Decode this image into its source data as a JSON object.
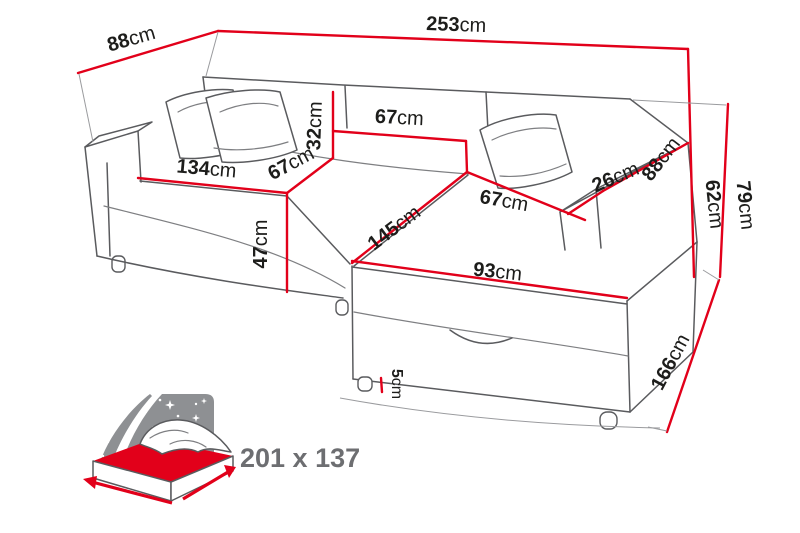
{
  "diagram_type": "corner-sofa-bed-dimension-diagram",
  "unit": "cm",
  "labels": {
    "back_depth": {
      "num": "88",
      "unit": "cm"
    },
    "total_width": {
      "num": "253",
      "unit": "cm"
    },
    "total_height": {
      "num": "79",
      "unit": "cm"
    },
    "armrest_height": {
      "num": "62",
      "unit": "cm"
    },
    "right_armrest_depth": {
      "num": "88",
      "unit": "cm"
    },
    "right_armrest_width": {
      "num": "26",
      "unit": "cm"
    },
    "chaise_length": {
      "num": "166",
      "unit": "cm"
    },
    "backrest_cushion_height": {
      "num": "32",
      "unit": "cm"
    },
    "backrest_cushion_width": {
      "num": "67",
      "unit": "cm"
    },
    "seat_depth": {
      "num": "67",
      "unit": "cm"
    },
    "right_seat_width": {
      "num": "67",
      "unit": "cm"
    },
    "left_seat_width": {
      "num": "134",
      "unit": "cm"
    },
    "chaise_depth": {
      "num": "145",
      "unit": "cm"
    },
    "chaise_front_width": {
      "num": "93",
      "unit": "cm"
    },
    "seat_height": {
      "num": "47",
      "unit": "cm"
    },
    "leg_height": {
      "num": "5",
      "unit": "cm"
    },
    "sleeping_area": {
      "num": "201 x 137",
      "unit": ""
    }
  },
  "icons": {
    "sleeping_area": "bed-mattress-icon",
    "night_sky": "starry-night-shape",
    "moon": "crescent-moon-shape",
    "arrows": "dimension-arrow-icon"
  },
  "colors": {
    "accent_red": "#e2001a",
    "outline_gray": "#5a5b5e",
    "night_sky_gray": "#8e9093",
    "label_gray": "#6d6e71",
    "text_black": "#1d1d1b",
    "background": "#ffffff"
  }
}
